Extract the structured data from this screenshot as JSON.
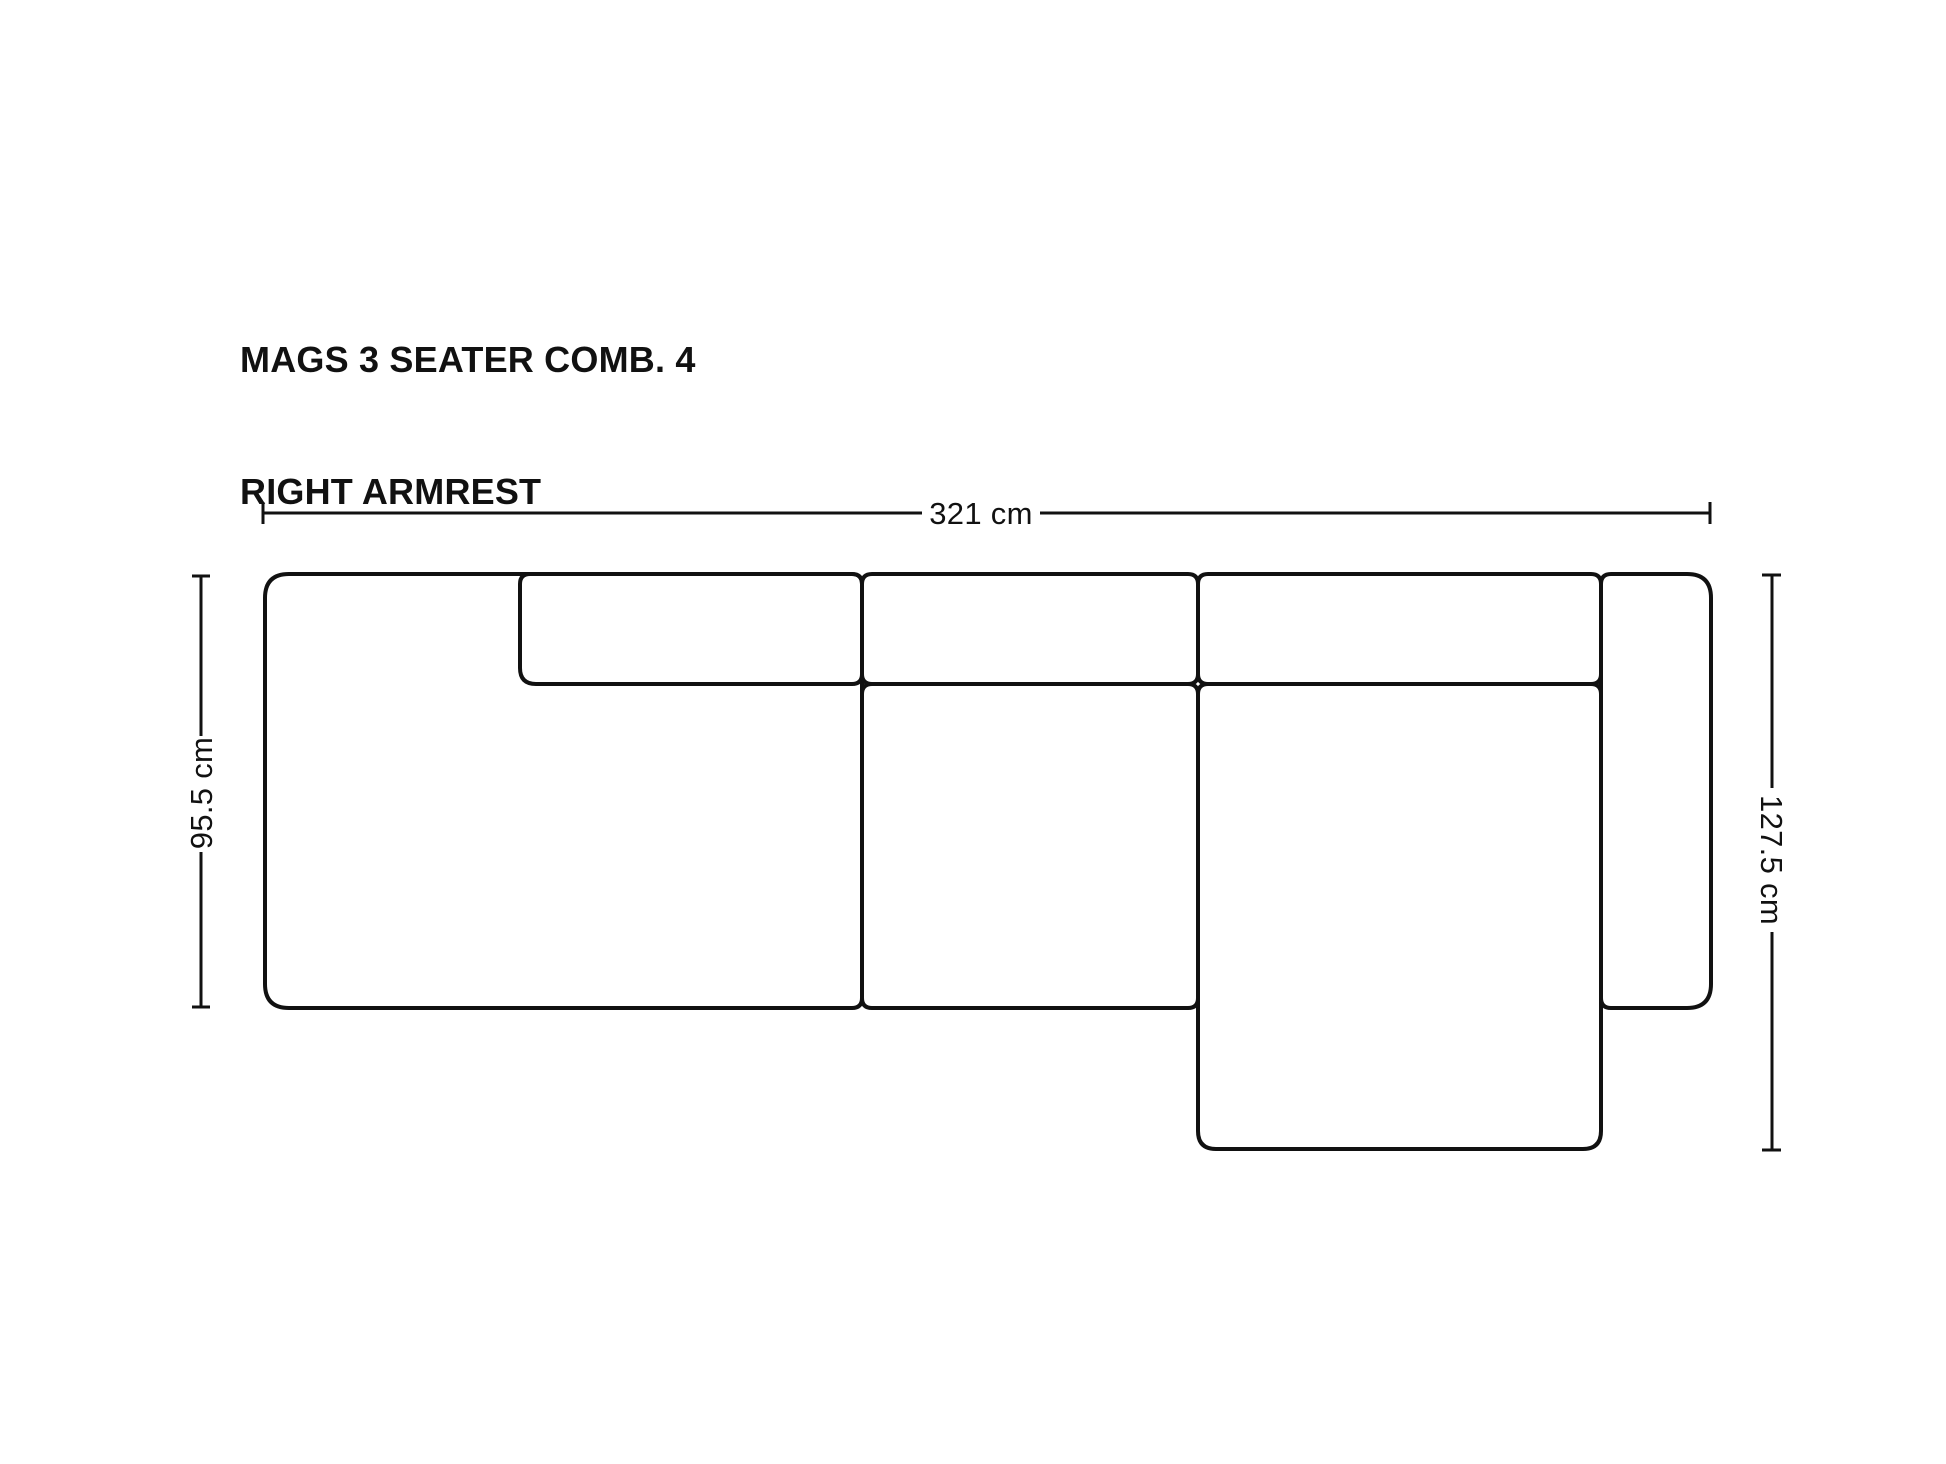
{
  "title": {
    "line1": "MAGS 3 SEATER COMB. 4",
    "line2": "RIGHT ARMREST"
  },
  "dimensions": {
    "overall_width_label": "321 cm",
    "left_depth_label": "95.5 cm",
    "right_depth_label": "127.5 cm"
  },
  "colors": {
    "line": "#111111",
    "text": "#111111",
    "background": "#ffffff"
  }
}
